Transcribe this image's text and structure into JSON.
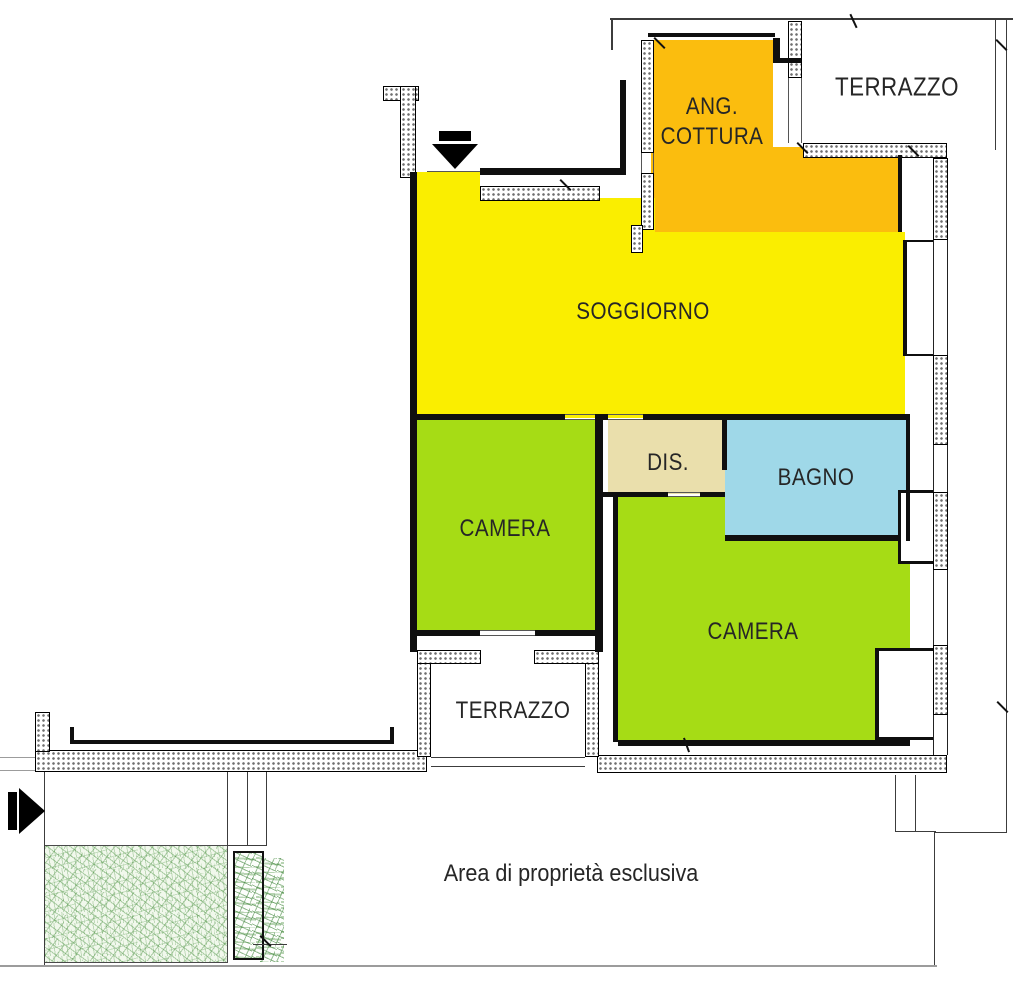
{
  "labels": {
    "terrazzo_top": "TERRAZZO",
    "ang_cottura_line1": "ANG.",
    "ang_cottura_line2": "COTTURA",
    "soggiorno": "SOGGIORNO",
    "dis": "DIS.",
    "bagno": "BAGNO",
    "camera_left": "CAMERA",
    "camera_right": "CAMERA",
    "terrazzo_bottom": "TERRAZZO",
    "area_esclusiva": "Area di proprietà esclusiva"
  },
  "colors": {
    "soggiorno": "#FAEE00",
    "ang_cottura": "#FBBD0E",
    "camera": "#A6DC15",
    "bagno": "#9FD8E8",
    "dis": "#EADFAC",
    "wall": "#0f0f0f",
    "garden_base": "#f1f8ec",
    "garden_stroke": "#5f9e55"
  },
  "icons": {
    "entrance_arrow": "down-arrow",
    "access_arrow": "right-arrow"
  }
}
